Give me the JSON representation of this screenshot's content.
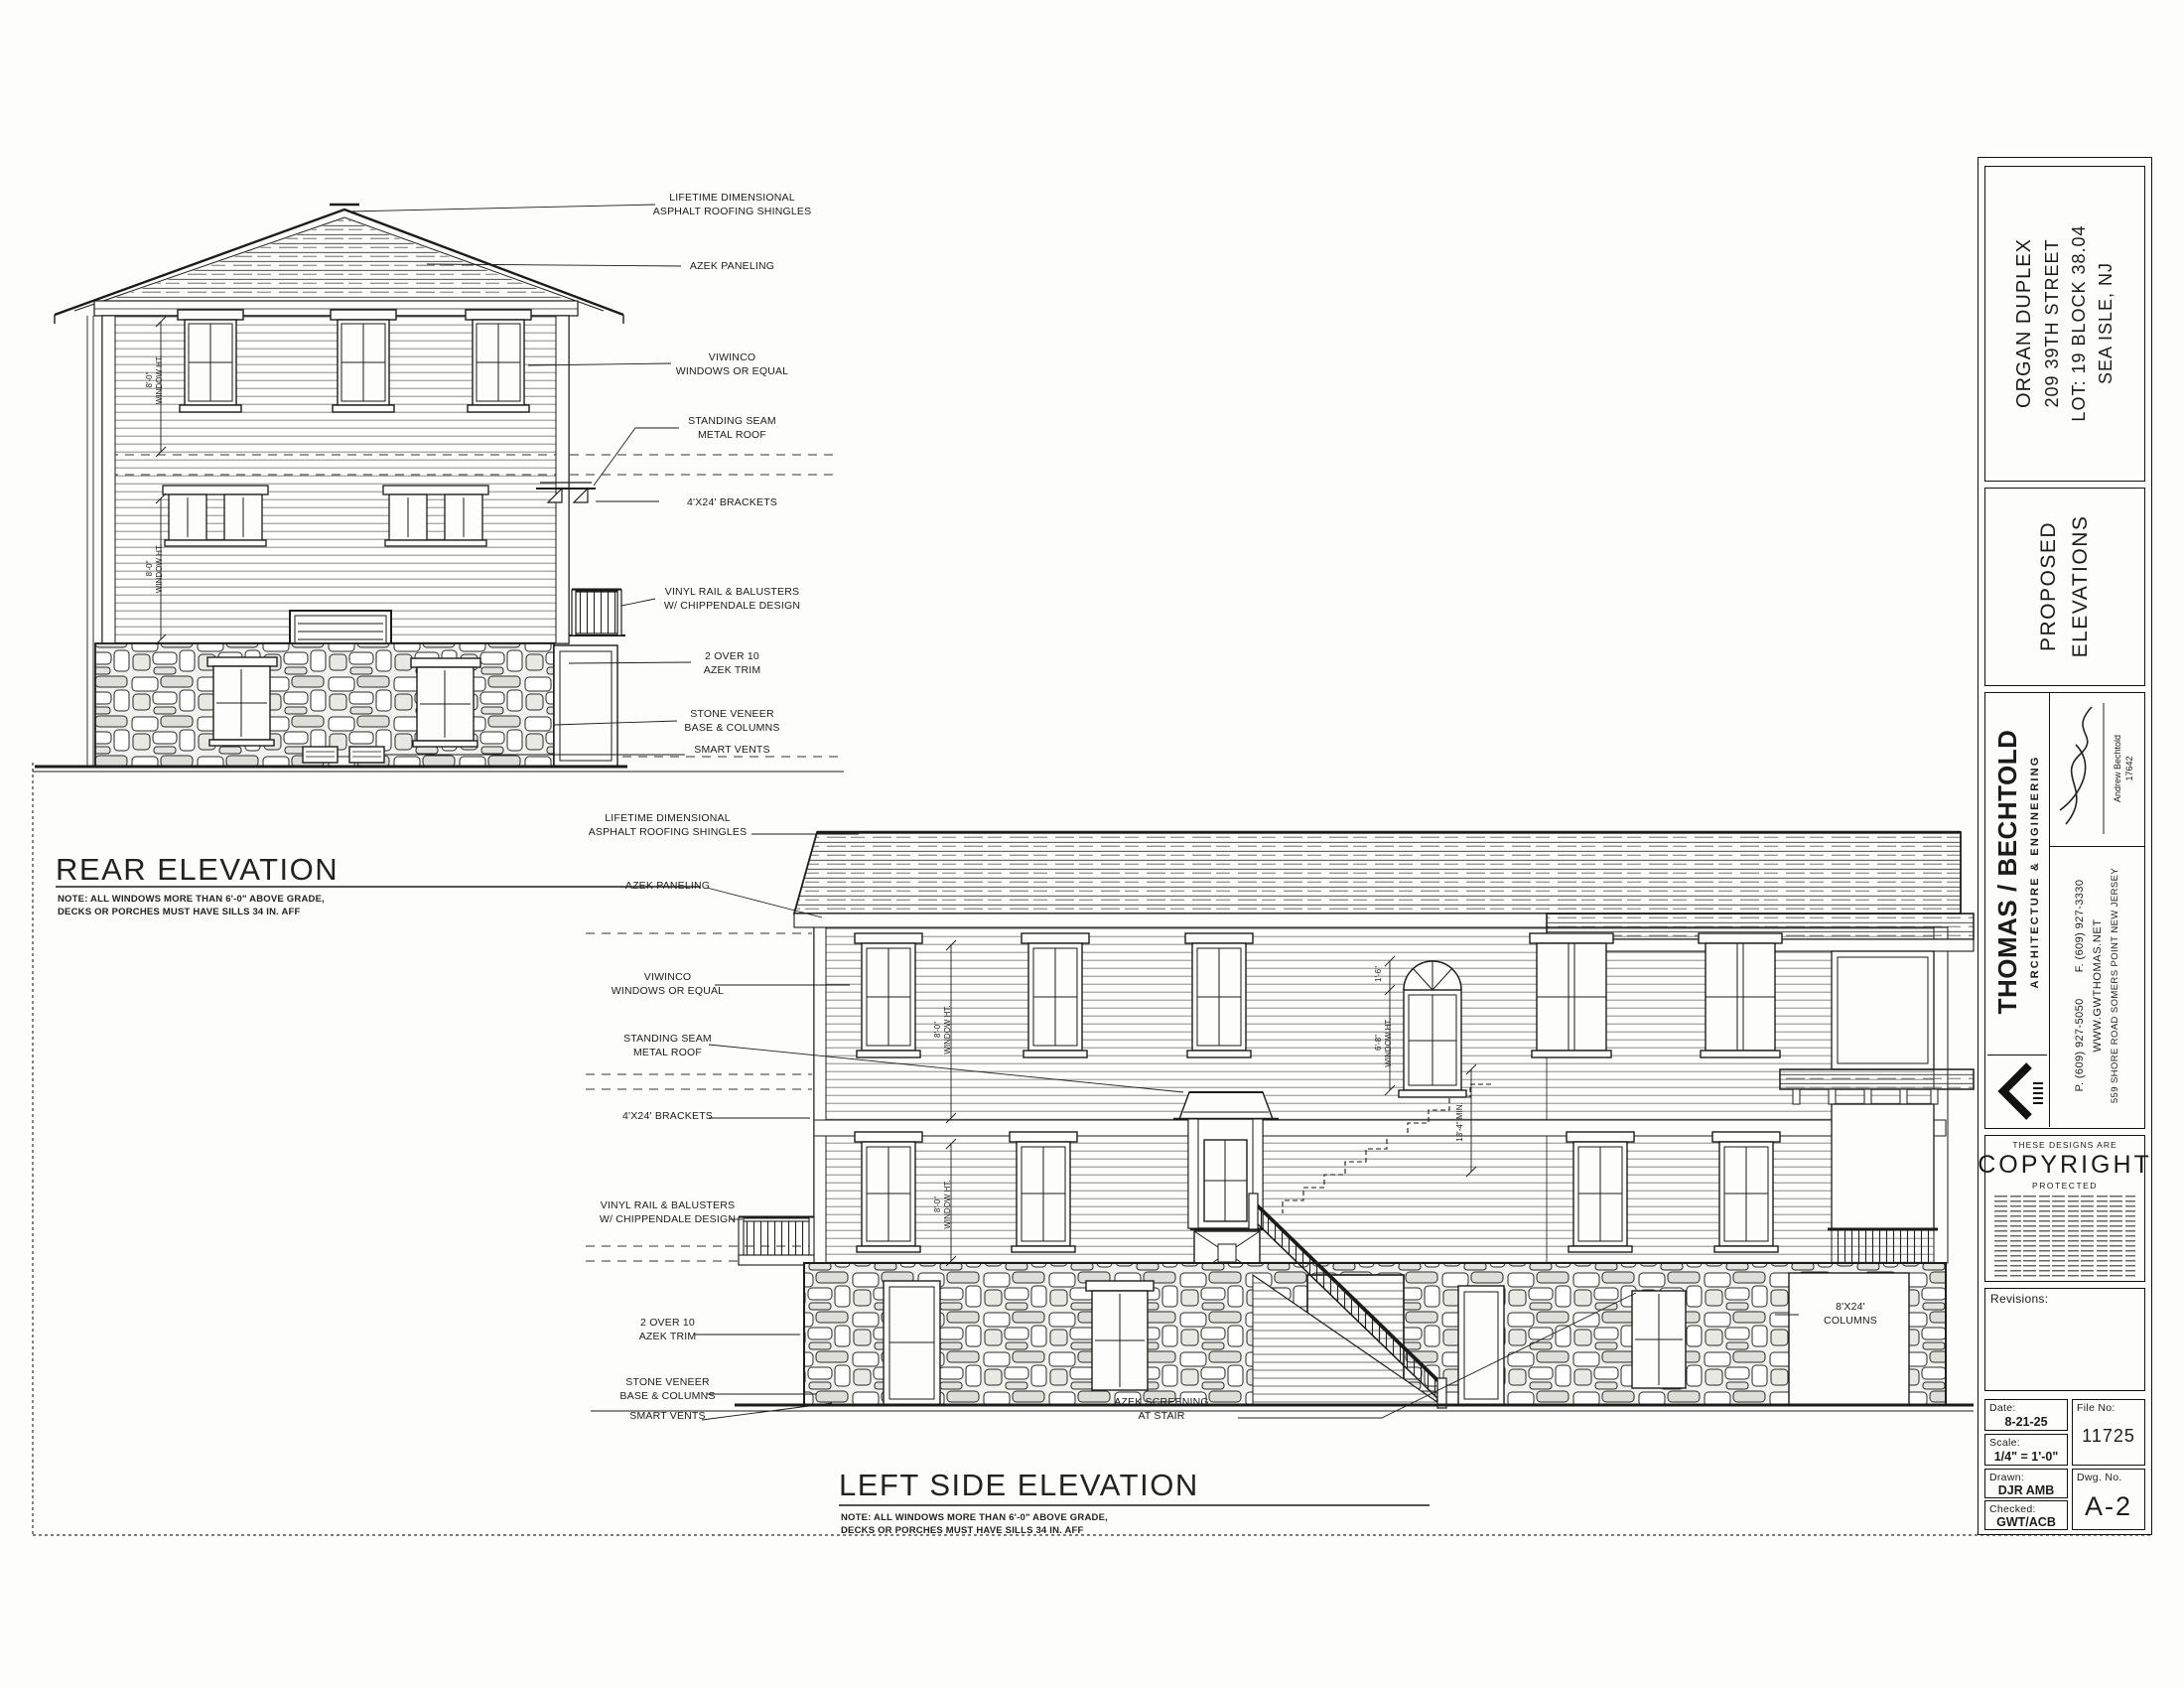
{
  "sheet": {
    "titles": {
      "rear": "REAR ELEVATION",
      "left": "LEFT SIDE ELEVATION",
      "note": "NOTE: ALL WINDOWS MORE THAN 6'-0\" ABOVE GRADE,\nDECKS OR PORCHES MUST HAVE SILLS 34 IN. AFF"
    },
    "callouts": {
      "shingles": "LIFETIME DIMENSIONAL\nASPHALT ROOFING SHINGLES",
      "azek_paneling": "AZEK PANELING",
      "windows": "VIWINCO\nWINDOWS OR EQUAL",
      "metal_roof": "STANDING SEAM\nMETAL ROOF",
      "brackets": "4'X24' BRACKETS",
      "rail": "VINYL RAIL & BALUSTERS\nW/ CHIPPENDALE DESIGN",
      "azek_trim": "2 OVER 10\nAZEK TRIM",
      "stone": "STONE VENEER\nBASE & COLUMNS",
      "vents": "SMART VENTS",
      "screening": "AZEK SCREENING\nAT STAIR",
      "columns": "8'X24'\nCOLUMNS"
    },
    "dims": {
      "win8": "8'-0\"\nWINDOW HT.",
      "win68": "6'-8\"\nWINDOW HT.",
      "d16": "1'-6\"",
      "d134": "13'-4\" MIN."
    },
    "titleblock": {
      "project": {
        "l1": "ORGAN DUPLEX",
        "l2": "209 39TH STREET",
        "l3": "LOT: 19  BLOCK 38.04",
        "l4": "SEA ISLE, NJ"
      },
      "sheet_title": {
        "l1": "PROPOSED",
        "l2": "ELEVATIONS"
      },
      "firm": {
        "name": "THOMAS / BECHTOLD",
        "tagline": "ARCHITECTURE & ENGINEERING",
        "phone": "P. (609) 927-5050",
        "fax": "F. (609) 927-3330",
        "web": "WWW.GWTHOMAS.NET",
        "address": "559 SHORE ROAD   SOMERS POINT   NEW JERSEY"
      },
      "signature": {
        "name": "Andrew Bechtold",
        "license": "17642"
      },
      "copyright": {
        "l1": "THESE DESIGNS ARE",
        "l2": "COPYRIGHT",
        "l3": "PROTECTED"
      },
      "revisions_label": "Revisions:",
      "fields": {
        "date_label": "Date:",
        "date": "8-21-25",
        "scale_label": "Scale:",
        "scale": "1/4\" = 1'-0\"",
        "drawn_label": "Drawn:",
        "drawn": "DJR AMB",
        "checked_label": "Checked:",
        "checked": "GWT/ACB",
        "fileno_label": "File No:",
        "fileno": "11725",
        "dwgno_label": "Dwg. No.",
        "dwgno": "A-2"
      }
    }
  }
}
